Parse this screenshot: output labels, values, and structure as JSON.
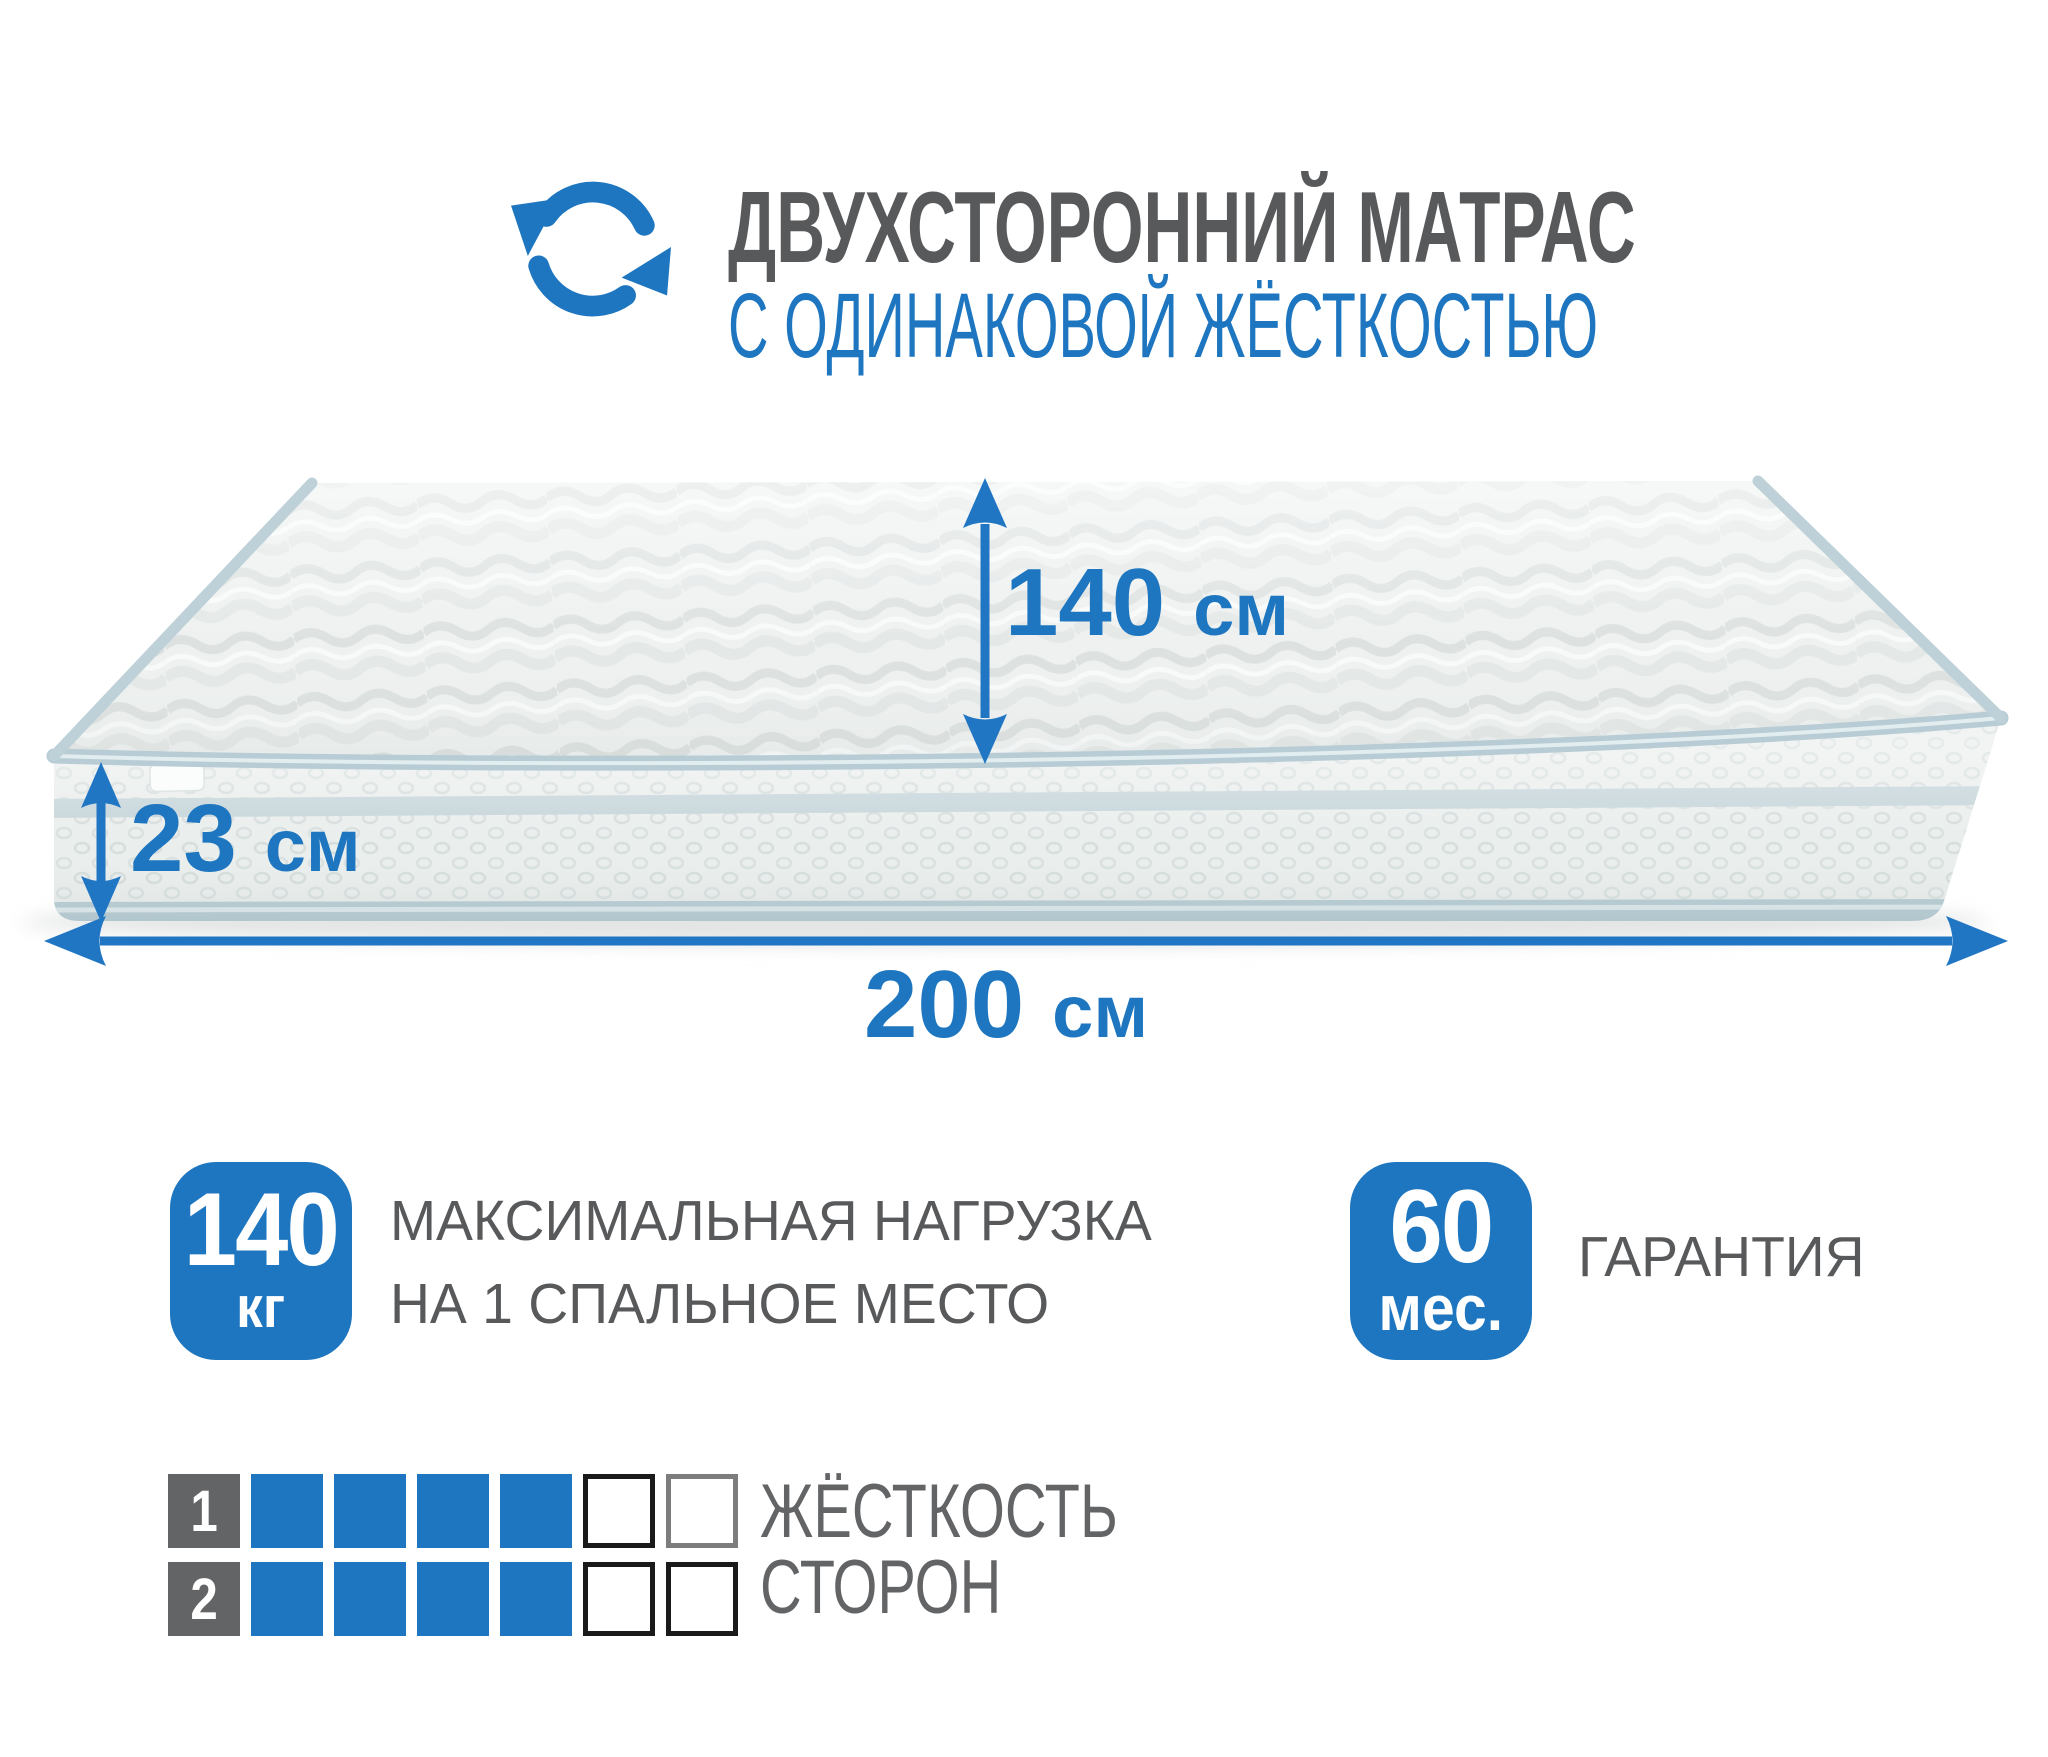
{
  "colors": {
    "accent_blue": "#1d76bf",
    "arrow_blue": "#2176c4",
    "title_gray": "#58595b",
    "label_gray": "#636466",
    "piping_teal": "#b7ccd4"
  },
  "header": {
    "icon": "rotate-arrows-icon",
    "title": "ДВУХСТОРОННИЙ МАТРАС",
    "subtitle": "С ОДИНАКОВОЙ ЖЁСТКОСТЬЮ"
  },
  "mattress": {
    "width": {
      "value": "140",
      "unit": "см"
    },
    "height": {
      "value": "23",
      "unit": "см"
    },
    "length": {
      "value": "200",
      "unit": "см"
    }
  },
  "badges": [
    {
      "value": "140",
      "unit": "кг",
      "caption": [
        "МАКСИМАЛЬНАЯ НАГРУЗКА",
        "НА 1 СПАЛЬНОЕ МЕСТО"
      ]
    },
    {
      "value": "60",
      "unit": "мес.",
      "caption": [
        "ГАРАНТИЯ"
      ]
    }
  ],
  "firmness": {
    "label": [
      "ЖЁСТКОСТЬ",
      "СТОРОН"
    ],
    "scale_total": 6,
    "rows": [
      {
        "side": "1",
        "filled": 4,
        "empty_borders": [
          "#1a1a1a",
          "#7d7d7d"
        ]
      },
      {
        "side": "2",
        "filled": 4,
        "empty_borders": [
          "#1a1a1a",
          "#1a1a1a"
        ]
      }
    ]
  }
}
